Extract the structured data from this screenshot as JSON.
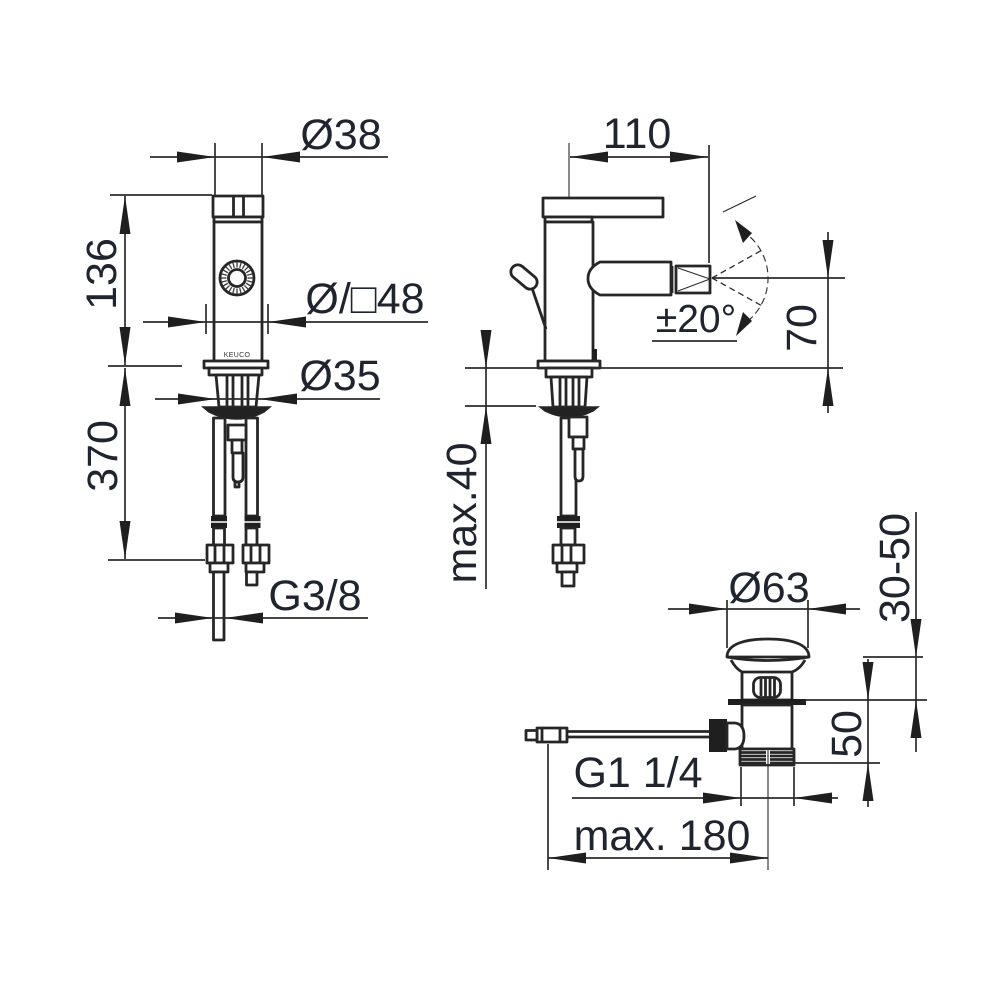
{
  "drawing": {
    "brand": "KEUCO",
    "front_view": {
      "top_diameter": "Ø38",
      "body_height": "136",
      "escutcheon_diameter": "Ø/□48",
      "shank_diameter": "Ø35",
      "hose_length": "370",
      "supply_thread": "G3/8"
    },
    "side_view": {
      "spout_reach": "110",
      "swivel_angle": "±20°",
      "spout_height": "70",
      "deck_thickness": "max.40"
    },
    "drain_view": {
      "plug_diameter": "Ø63",
      "mount_range": "30-50",
      "body_height": "50",
      "waste_thread": "G1 1/4",
      "rod_length": "max. 180"
    },
    "colors": {
      "line": "#262626",
      "text": "#20242e",
      "background": "#ffffff"
    }
  }
}
